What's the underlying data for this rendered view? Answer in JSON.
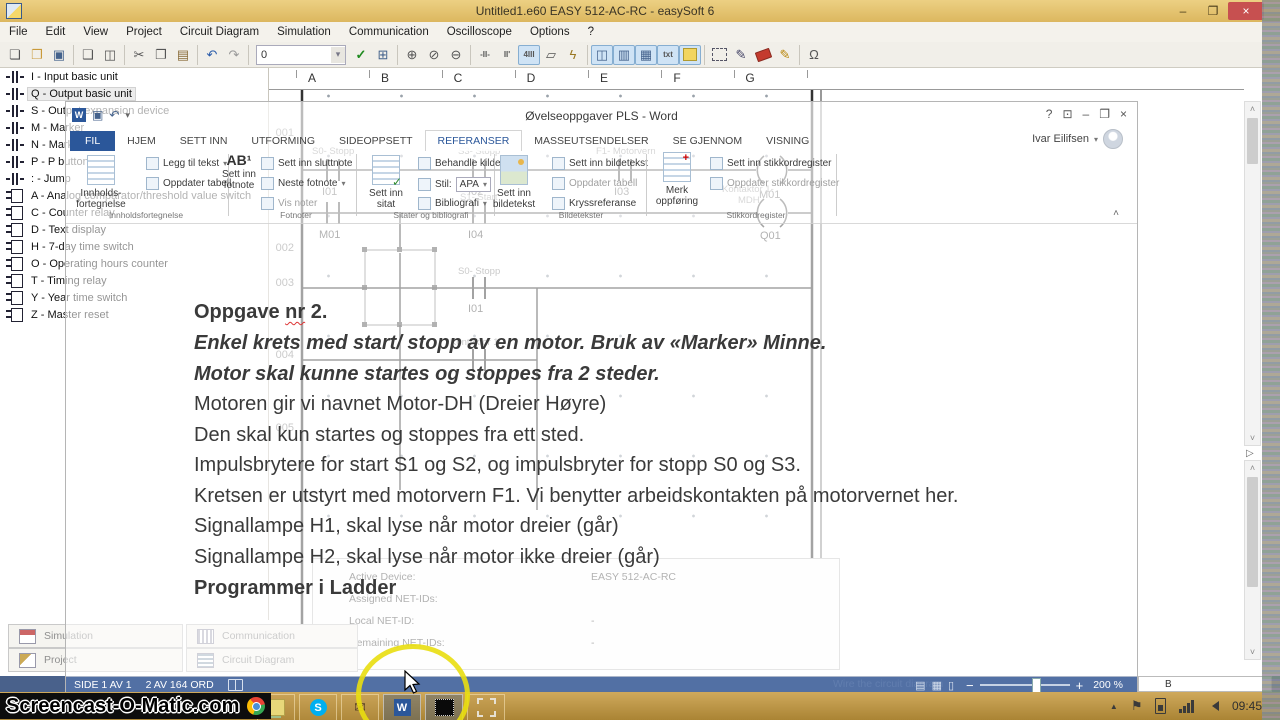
{
  "easysoft": {
    "title": "Untitled1.e60 EASY 512-AC-RC - easySoft 6",
    "menu": [
      "File",
      "Edit",
      "View",
      "Project",
      "Circuit Diagram",
      "Simulation",
      "Communication",
      "Oscilloscope",
      "Options",
      "?"
    ],
    "toolbar": {
      "combo_value": "0",
      "contact_tool_1": "-II-",
      "contact_tool_2": "II'",
      "contact_tool_3": "4III",
      "txt_tool": "txt"
    },
    "toolbox": {
      "items": [
        "I - Input basic unit",
        "Q - Output basic unit",
        "S - Output expansion device",
        "M - Marker",
        "N - Marker",
        "P - P button",
        ": - Jump",
        "A - Analog comparator/threshold value switch",
        "C - Counter relay",
        "D - Text display",
        "H - 7-day time switch",
        "O - Operating hours counter",
        "T - Timing relay",
        "Y - Year time switch",
        "Z - Master reset"
      ]
    },
    "grid_columns": [
      "A",
      "B",
      "C",
      "D",
      "E",
      "F",
      "G"
    ],
    "ladder": {
      "nums": [
        "001",
        "002",
        "003",
        "004",
        "005"
      ],
      "r1c1_top": "S0- Stopp",
      "r1c1_bot": "I01",
      "r1c2_top": "S3- Stopp",
      "r1c2_bot": "I02",
      "r1c3_top": "F1- Motorvern",
      "r1c3_bot": "I03",
      "r1_coil": "M01",
      "r2c1_bot": "M01",
      "r2c2_top": "S1- Start",
      "r2c2_bot": "I04",
      "r2_coil_top1": "Kontaktor 1-",
      "r2_coil_top2": "MDH",
      "r2_coil": "Q01",
      "r3c_top": "S0- Stopp",
      "r3c_bot": "I01",
      "r4c_top": "Kontaktor 1-"
    },
    "properties": {
      "row1_label": "Active Device:",
      "row1_value": "EASY 512-AC-RC",
      "row2_label": "Assigned NET-IDs:",
      "row2_value": "",
      "row3_label": "Local NET-ID:",
      "row3_value": "-",
      "row4_label": "Remaining NET-IDs:",
      "row4_value": "-"
    },
    "panel_buttons": [
      "Simulation",
      "Communication",
      "Project",
      "Circuit Diagram"
    ],
    "statusbar": {
      "hint": "Wire the circuit diagram",
      "side_label": "B"
    }
  },
  "word": {
    "title": "Øvelseoppgaver PLS - Word",
    "account": "Ivar Eilifsen",
    "tabs": [
      "FIL",
      "HJEM",
      "SETT INN",
      "UTFORMING",
      "SIDEOPPSETT",
      "REFERANSER",
      "MASSEUTSENDELSER",
      "SE GJENNOM",
      "VISNING"
    ],
    "ribbon": {
      "toc_big1": "Innholds-",
      "toc_big2": "fortegnelse",
      "toc_add": "Legg til tekst",
      "toc_upd": "Oppdater tabell",
      "toc_group": "Innholdsfortegnelse",
      "fot_ab": "AB¹",
      "fot_big1": "Sett inn",
      "fot_big2": "fotnote",
      "fot_slutt": "Sett inn sluttnote",
      "fot_neste": "Neste fotnote",
      "fot_vis": "Vis noter",
      "fot_group": "Fotnoter",
      "sit_big1": "Sett inn",
      "sit_big2": "sitat",
      "sit_beh": "Behandle kilder",
      "sit_stil": "Stil:",
      "sit_stil_val": "APA",
      "sit_bib": "Bibliografi",
      "sit_group": "Sitater og bibliografi",
      "bld_s1": "Sett inn bildetekst",
      "bld_s2": "Oppdater tabell",
      "bld_s3": "Kryssreferanse",
      "bld_big1": "Sett inn",
      "bld_big2": "bildetekst",
      "bld_group": "Bildetekster",
      "merk_big1": "Merk",
      "merk_big2": "oppføring",
      "stikk_s1": "Sett inn stikkordregister",
      "stikk_s2": "Oppdater stikkordregister",
      "stikk_group": "Stikkordregister"
    },
    "document": {
      "l1a": "Oppgave ",
      "l1b": "nr",
      "l1c": " 2.",
      "lines": [
        "Enkel krets med start/ stopp av en motor. Bruk av «Marker» Minne.",
        "Motor skal kunne startes og stoppes fra 2 steder.",
        "Motoren gir vi navnet Motor-DH (Dreier Høyre)",
        "Den skal kun startes og stoppes fra ett sted.",
        "Impulsbrytere for start S1 og S2, og impulsbryter for stopp S0 og S3.",
        "Kretsen er utstyrt med motorvern F1. Vi benytter arbeidskontakten på motorvernet her.",
        "Signallampe H1, skal lyse når motor dreier (går)",
        "Signallampe H2, skal lyse når motor ikke dreier (går)",
        "Programmer i Ladder"
      ]
    },
    "status": {
      "page": "SIDE 1 AV 1",
      "words": "2 AV 164 ORD",
      "zoom": "200 %"
    }
  },
  "taskbar": {
    "watermark": "Screencast-O-Matic.com",
    "time": "09:45"
  },
  "icons": {
    "new": "❏",
    "open": "❐",
    "save": "▣",
    "print": "❑",
    "preview": "◫",
    "cut": "✂",
    "copy": "❐",
    "paste": "▤",
    "undo": "↶",
    "redo": "↷",
    "check": "✓",
    "grid": "⊞",
    "zoom_in": "⊕",
    "zoom_orig": "⊘",
    "zoom_out": "⊖",
    "layers": "▱",
    "lightning": "ϟ",
    "view1": "◫",
    "view2": "▥",
    "grid2": "▦",
    "edit": "✎",
    "edit2": "✎",
    "omega": "Ω",
    "dropdown": "▾",
    "min": "–",
    "max": "❐",
    "close": "×",
    "help": "?",
    "pin": "⊡",
    "up": "˄",
    "down": "˅",
    "play": "▷",
    "tray_up": "▲",
    "flag": "⚑",
    "chevron": "˄"
  }
}
